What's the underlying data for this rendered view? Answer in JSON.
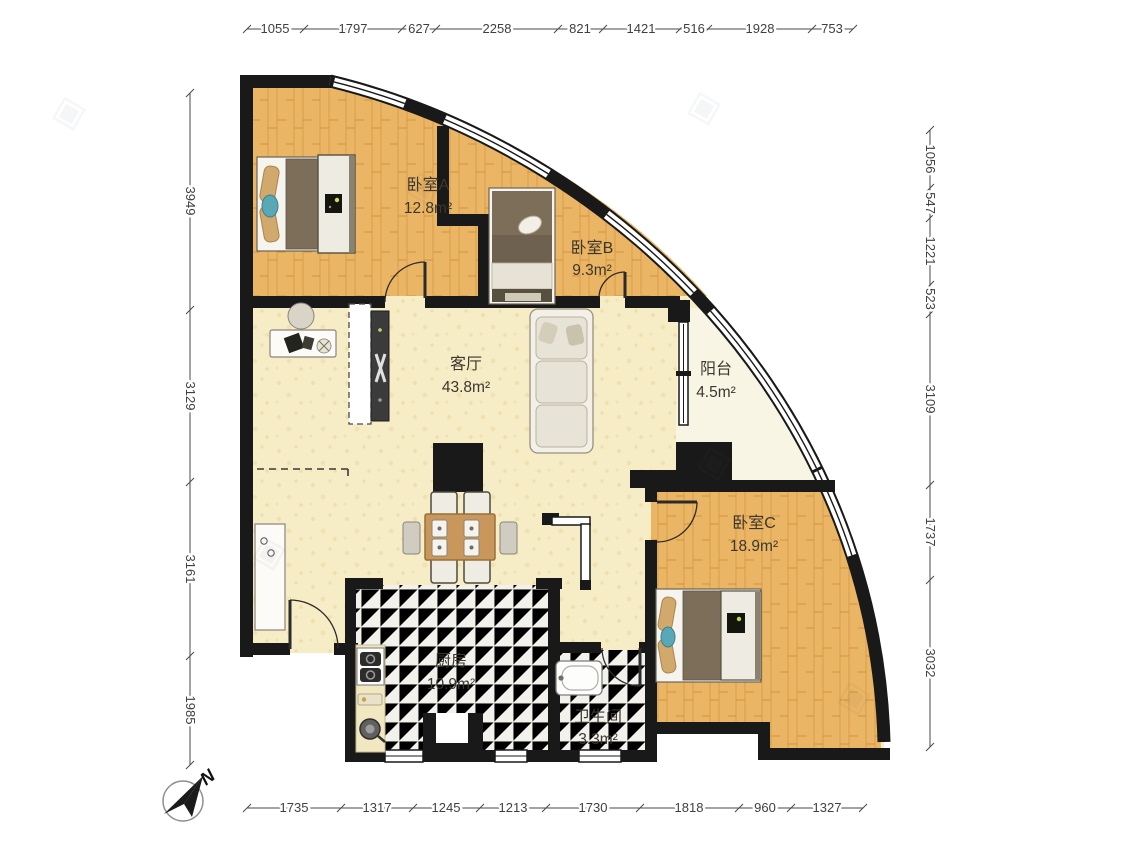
{
  "rooms": {
    "bedroomA": {
      "name": "卧室A",
      "area": "12.8m²"
    },
    "bedroomB": {
      "name": "卧室B",
      "area": "9.3m²"
    },
    "livingRoom": {
      "name": "客厅",
      "area": "43.8m²"
    },
    "balcony": {
      "name": "阳台",
      "area": "4.5m²"
    },
    "bedroomC": {
      "name": "卧室C",
      "area": "18.9m²"
    },
    "kitchen": {
      "name": "厨房",
      "area": "10.9m²"
    },
    "bathroom": {
      "name": "卫生间",
      "area": "3.3m²"
    }
  },
  "dimensions_mm": {
    "top": [
      "1055",
      "1797",
      "627",
      "2258",
      "821",
      "1421",
      "516",
      "1928",
      "753"
    ],
    "left": [
      "3949",
      "3129",
      "3161",
      "1985"
    ],
    "right": [
      "1056",
      "547",
      "1221",
      "523",
      "3109",
      "1737",
      "3032"
    ],
    "bottom": [
      "1735",
      "1317",
      "1245",
      "1213",
      "1730",
      "1818",
      "960",
      "1327"
    ]
  },
  "compass": {
    "north_label": "N"
  },
  "colors": {
    "wall": "#191919",
    "bedroom_floor": "#eab564",
    "living_floor": "#f6ecc6",
    "tile_floor": "#f2f1ec",
    "balcony_floor": "#f9f5e4",
    "wood_furniture": "#c9975c",
    "teal_accent": "#58a8b6"
  }
}
